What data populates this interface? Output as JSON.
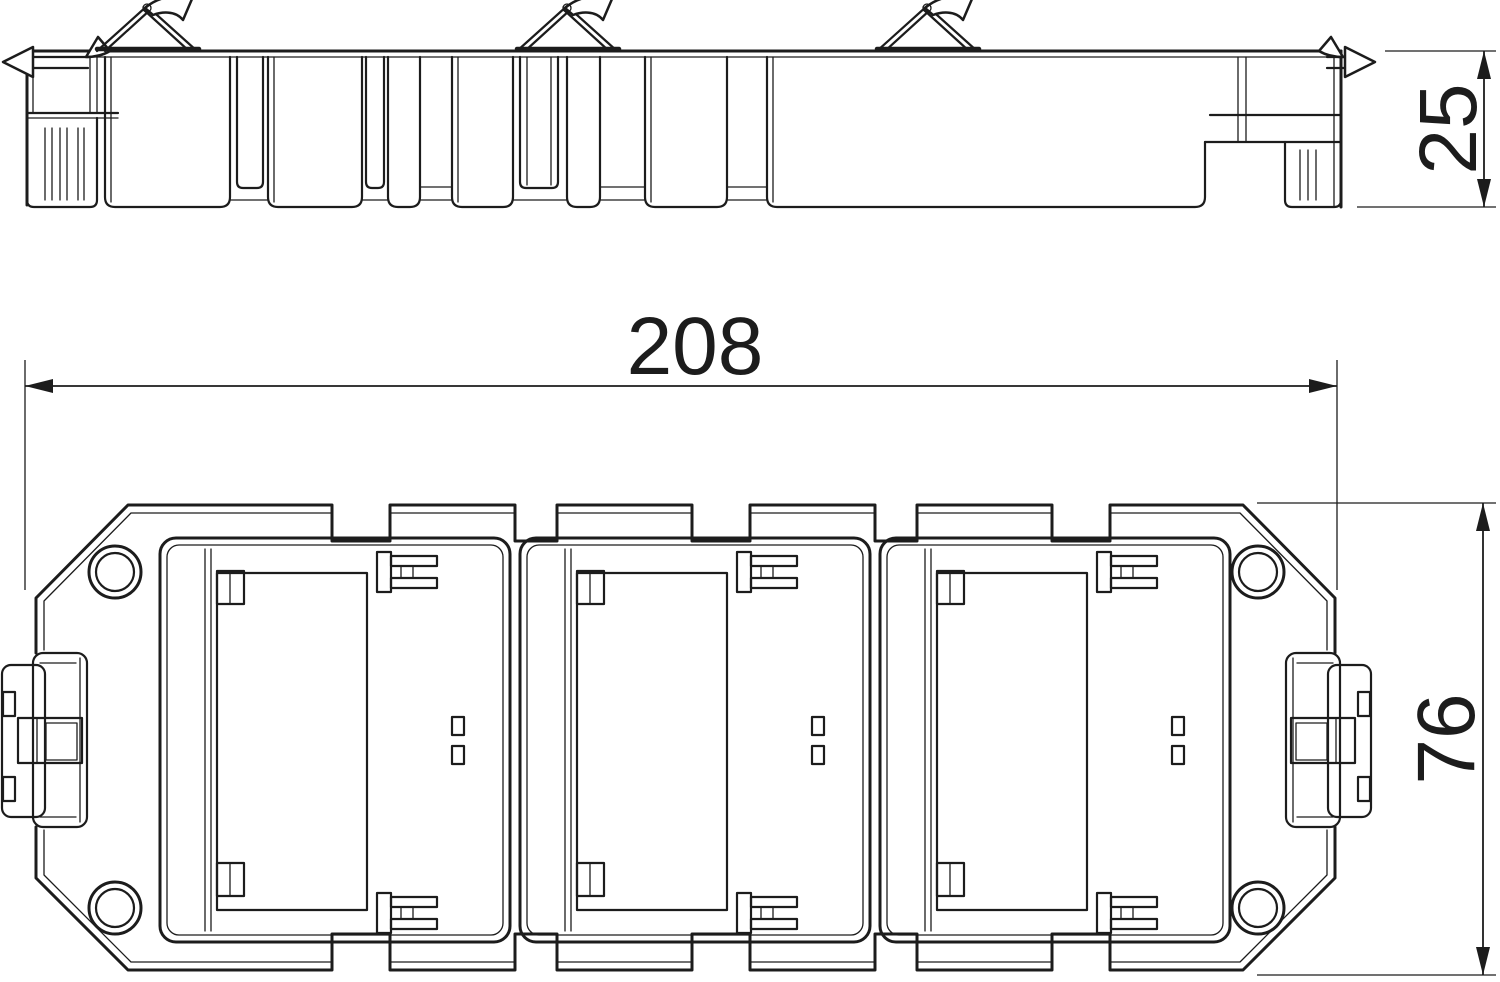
{
  "document": {
    "kind": "technical-drawing",
    "background_color": "#ffffff",
    "line_color": "#1c1c1c"
  },
  "dimensions": {
    "width": "208",
    "depth": "76",
    "height": "25"
  }
}
